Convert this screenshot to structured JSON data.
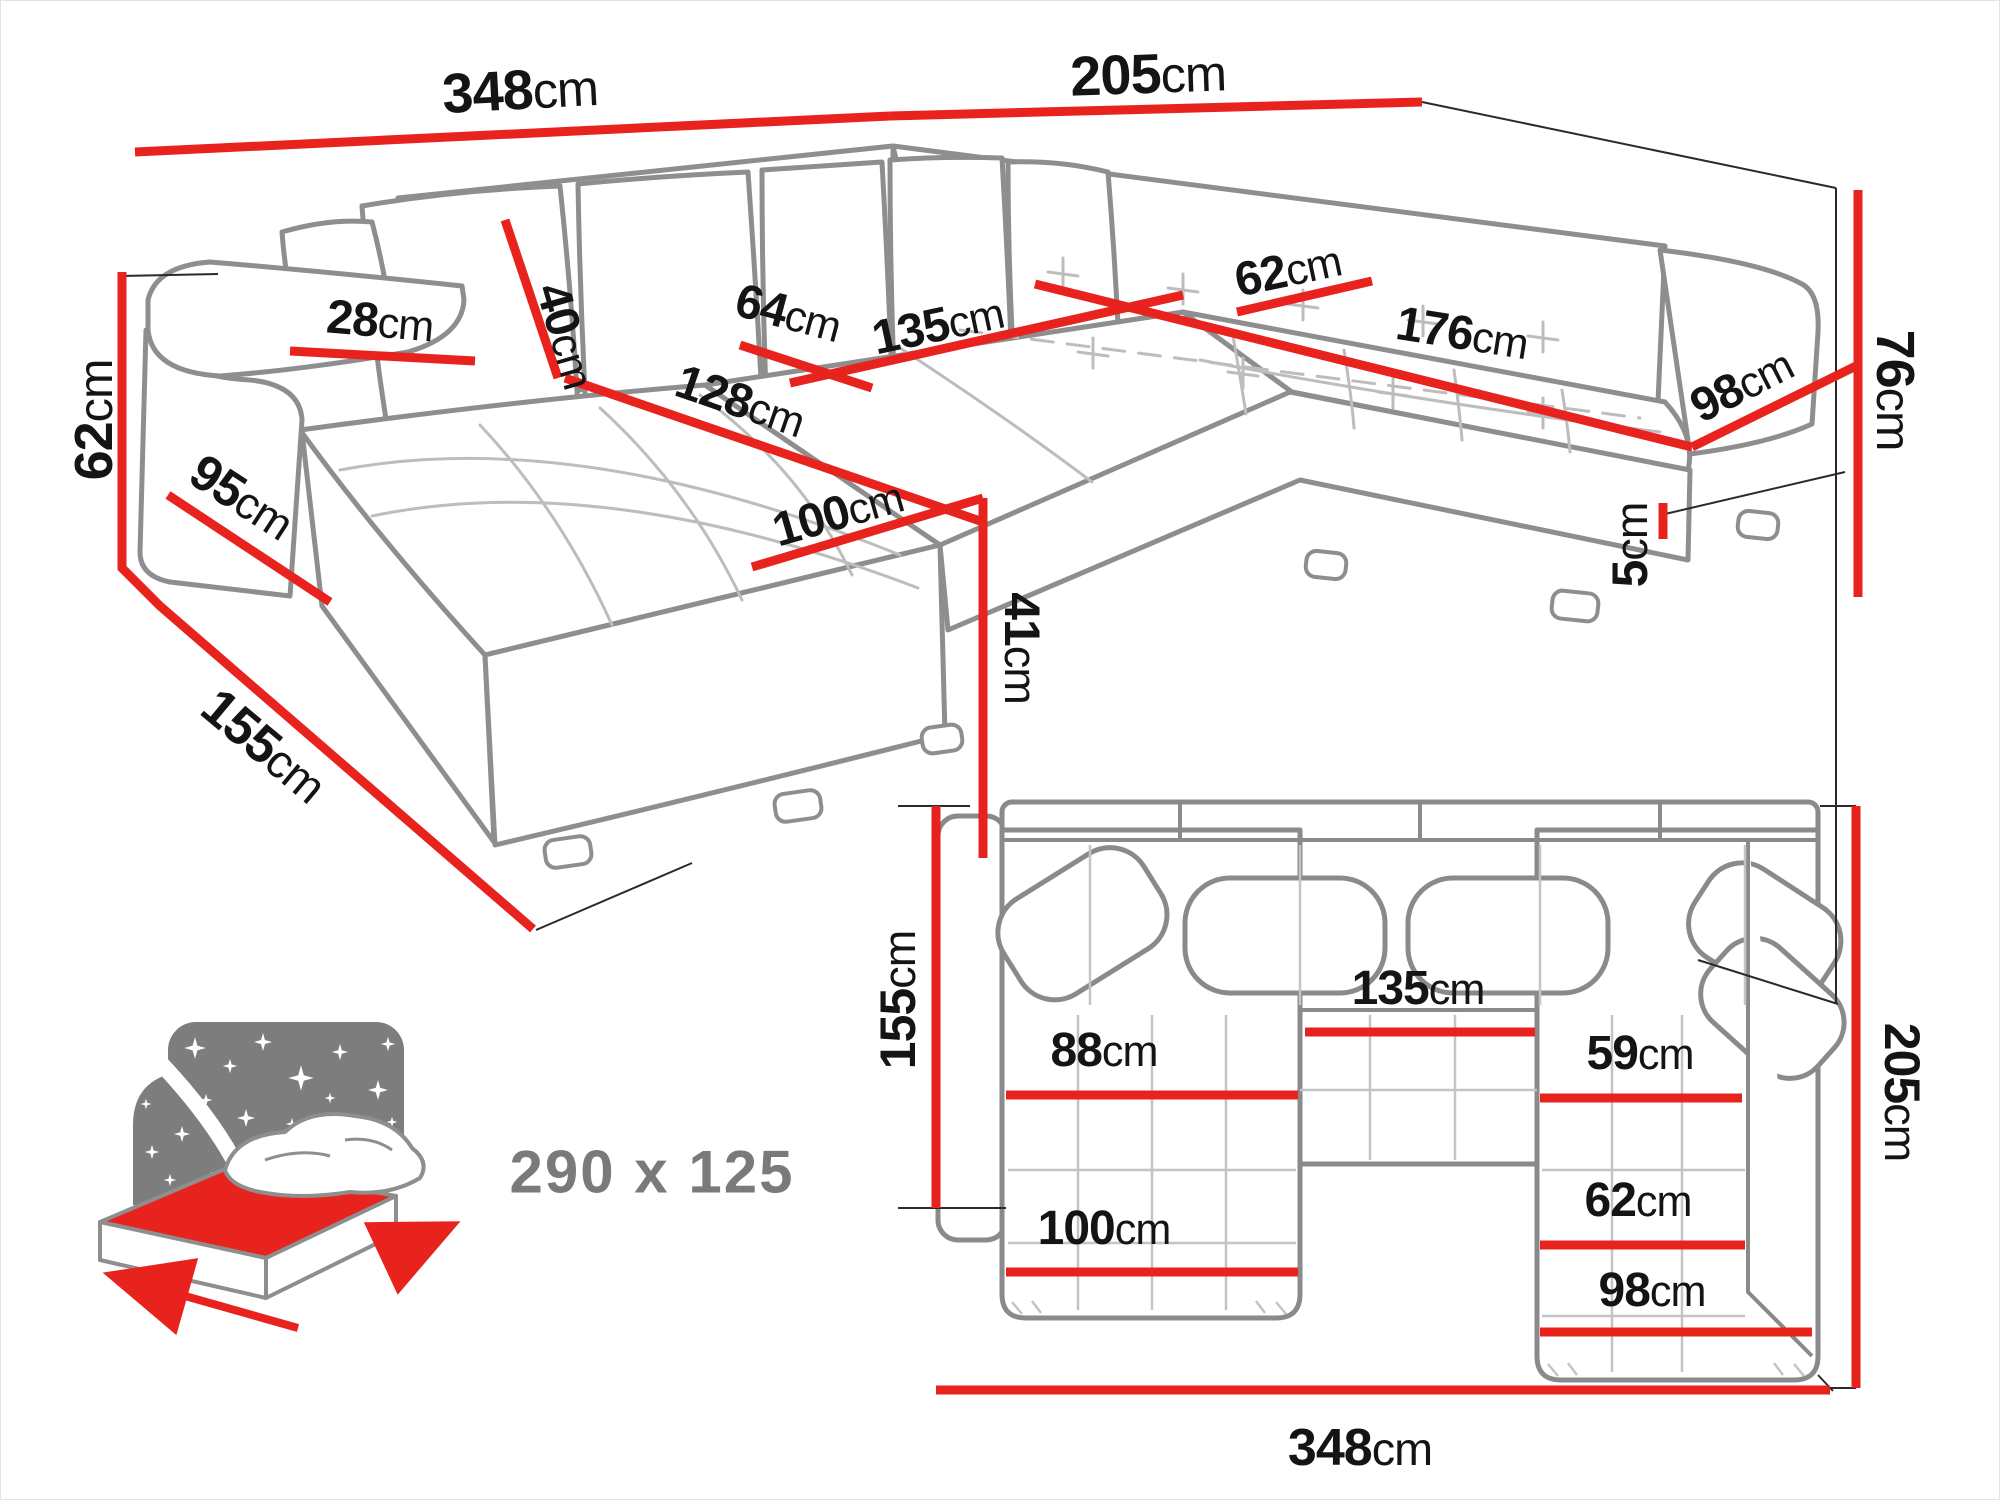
{
  "colors": {
    "dimension_red": "#e8231d",
    "outline_gray": "#8e8e8e",
    "light_gray": "#c4c4c4",
    "text_black": "#141414",
    "muted_gray": "#7a7a7a"
  },
  "perspective_view": {
    "description": "corner sofa perspective drawing with red dimension lines",
    "dimensions": [
      {
        "id": "total-width",
        "value": "348",
        "unit": "cm"
      },
      {
        "id": "right-depth",
        "value": "205",
        "unit": "cm"
      },
      {
        "id": "backrest-height",
        "value": "76",
        "unit": "cm"
      },
      {
        "id": "leg-height",
        "value": "5",
        "unit": "cm"
      },
      {
        "id": "armrest-height",
        "value": "62",
        "unit": "cm"
      },
      {
        "id": "armrest-depth",
        "value": "95",
        "unit": "cm"
      },
      {
        "id": "armrest-width",
        "value": "28",
        "unit": "cm"
      },
      {
        "id": "chaise-total-depth",
        "value": "155",
        "unit": "cm"
      },
      {
        "id": "back-cushion-height",
        "value": "40",
        "unit": "cm"
      },
      {
        "id": "chaise-length",
        "value": "128",
        "unit": "cm"
      },
      {
        "id": "seat-depth",
        "value": "64",
        "unit": "cm"
      },
      {
        "id": "middle-seat-width",
        "value": "135",
        "unit": "cm"
      },
      {
        "id": "chaise-width",
        "value": "100",
        "unit": "cm"
      },
      {
        "id": "seat-height",
        "value": "41",
        "unit": "cm"
      },
      {
        "id": "corner-seat-width",
        "value": "62",
        "unit": "cm"
      },
      {
        "id": "right-seat-length",
        "value": "176",
        "unit": "cm"
      },
      {
        "id": "right-seat-width",
        "value": "98",
        "unit": "cm"
      }
    ]
  },
  "plan_view": {
    "description": "top-down plan of the U-shaped sofa with red dimension lines",
    "dimensions": [
      {
        "id": "plan-left-depth",
        "value": "155",
        "unit": "cm"
      },
      {
        "id": "plan-right-depth",
        "value": "205",
        "unit": "cm"
      },
      {
        "id": "plan-total-width",
        "value": "348",
        "unit": "cm"
      },
      {
        "id": "plan-chaise-seat",
        "value": "88",
        "unit": "cm"
      },
      {
        "id": "plan-middle-seat",
        "value": "135",
        "unit": "cm"
      },
      {
        "id": "plan-corner-seat",
        "value": "59",
        "unit": "cm"
      },
      {
        "id": "plan-right-seat",
        "value": "62",
        "unit": "cm"
      },
      {
        "id": "plan-chaise-width",
        "value": "100",
        "unit": "cm"
      },
      {
        "id": "plan-right-width",
        "value": "98",
        "unit": "cm"
      }
    ]
  },
  "sleeping_area": {
    "label": "290 x 125"
  }
}
